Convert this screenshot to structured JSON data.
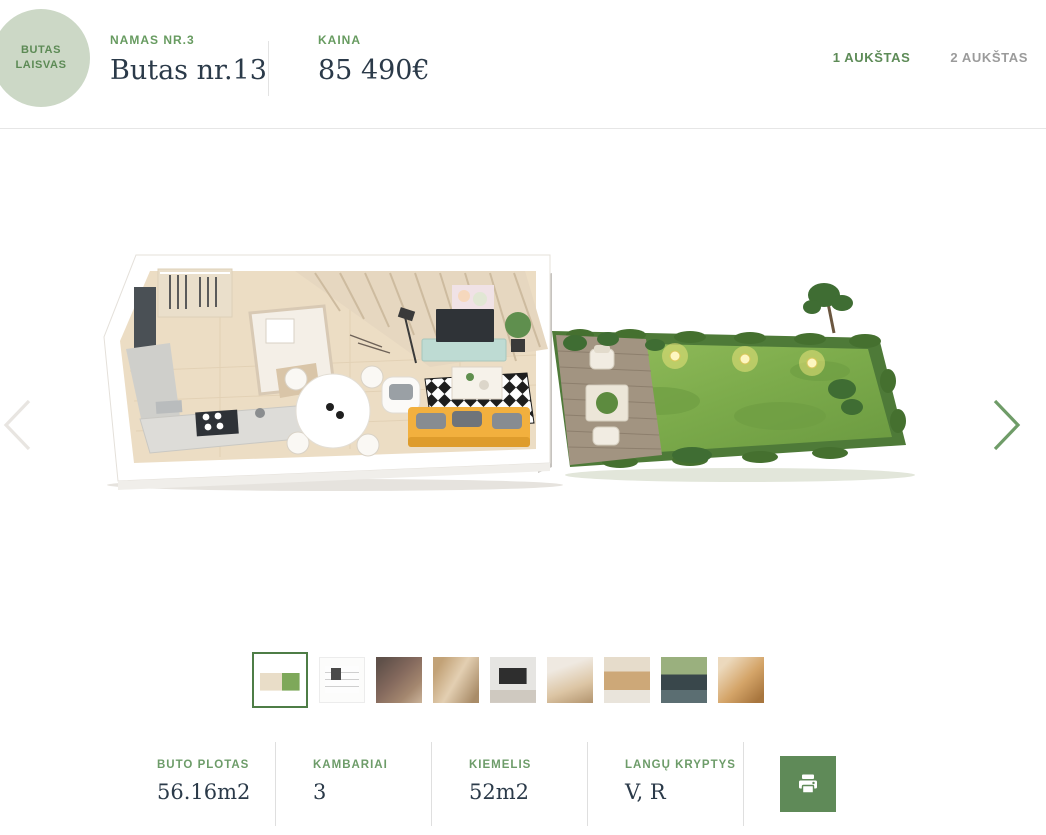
{
  "colors": {
    "accent_green": "#5d8b57",
    "badge_bg": "#ccd8c6",
    "dark_text": "#2b3a49",
    "button_green": "#5f8a58",
    "inactive_gray": "#9b9b9b"
  },
  "status_badge": {
    "line1": "BUTAS",
    "line2": "LAISVAS"
  },
  "header": {
    "house_label": "NAMAS NR.3",
    "title": "Butas nr.13",
    "price_label": "KAINA",
    "price": "85 490€",
    "floor_tabs": [
      {
        "label": "1 AUKŠTAS",
        "active": true
      },
      {
        "label": "2 AUKŠTAS",
        "active": false
      }
    ]
  },
  "carousel": {
    "slide_alt": "3D floor plan of first floor with private garden",
    "prev_icon": "chevron-left",
    "next_icon": "chevron-right"
  },
  "gallery": {
    "thumbnails": [
      {
        "title": "3D floor plan with garden",
        "selected": true
      },
      {
        "title": "2D architectural plan",
        "selected": false
      },
      {
        "title": "Living room photo",
        "selected": false
      },
      {
        "title": "Dining nook photo",
        "selected": false
      },
      {
        "title": "TV wall photo",
        "selected": false
      },
      {
        "title": "Dining room photo",
        "selected": false
      },
      {
        "title": "Kitchen photo",
        "selected": false
      },
      {
        "title": "Kitchen sink and window photo",
        "selected": false
      },
      {
        "title": "Staircase photo",
        "selected": false
      }
    ]
  },
  "stats": [
    {
      "label": "BUTO PLOTAS",
      "value": "56.16m2"
    },
    {
      "label": "KAMBARIAI",
      "value": "3"
    },
    {
      "label": "KIEMELIS",
      "value": "52m2"
    },
    {
      "label": "LANGŲ KRYPTYS",
      "value": "V, R"
    }
  ],
  "print_button": {
    "icon": "printer"
  }
}
